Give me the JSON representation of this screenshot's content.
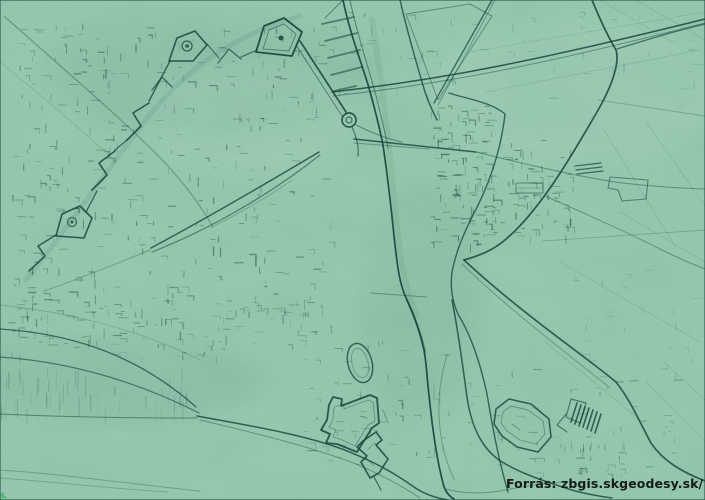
{
  "map": {
    "type": "lidar-hillshade-relief",
    "caption": "Forrás: zbgis.skgeodesy.sk/ Lidar",
    "colors": {
      "terrain_base": "#9ccdb3",
      "relief_line": "#16443a",
      "caption_text": "#141c18",
      "artifact_green": "#46b36b"
    },
    "features": [
      "bastioned-fortification-arc",
      "pentagonal-bastions-with-towers",
      "lens-shaped-embankment",
      "river-main-channel",
      "river-side-arm-and-island",
      "bridge-crossing",
      "long-straight-highway",
      "northeast-road-junction",
      "southwest-levee-lines",
      "star-fort",
      "arrow-ravelin",
      "oval-track",
      "polygonal-fort",
      "hatched-building",
      "field-parcel-lines",
      "urban-block-texture"
    ]
  }
}
